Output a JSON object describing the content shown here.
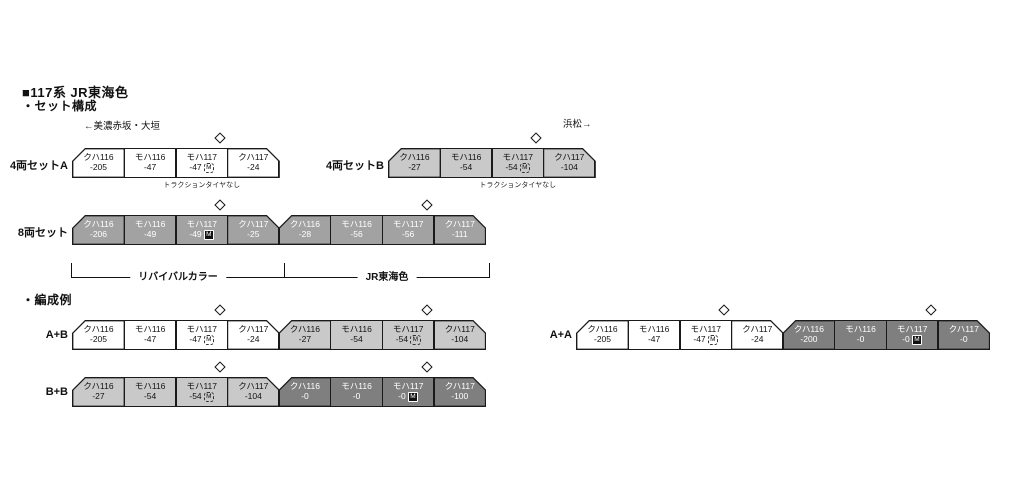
{
  "page": {
    "title": "■117系 JR東海色",
    "section_sets": "・セット構成",
    "section_examples": "・編成例",
    "direction_left": "←美濃赤坂・大垣",
    "direction_right": "浜松→"
  },
  "strings": {
    "m_label": "M"
  },
  "bracket": {
    "left_label": "リバイバルカラー",
    "right_label": "JR東海色"
  },
  "trains": [
    {
      "id": "set-4a",
      "label": "4両セットA",
      "x": 72,
      "y": 148,
      "cars": [
        {
          "type": "クハ116",
          "num": "-205",
          "shape": "cab-left",
          "style": "white",
          "note": "＞(消灯スイッチ付)",
          "noteAlign": "left"
        },
        {
          "type": "モハ116",
          "num": "-47",
          "shape": "mid",
          "style": "white"
        },
        {
          "type": "モハ117",
          "num": "-47",
          "m": "dashed",
          "pantograph": true,
          "shape": "mid",
          "style": "white",
          "note": "トラクションタイヤなし",
          "noteAlign": "center"
        },
        {
          "type": "クハ117",
          "num": "-24",
          "shape": "cab-right",
          "style": "white",
          "note": "(消灯スイッチ付)＜",
          "noteAlign": "right"
        }
      ]
    },
    {
      "id": "set-4b",
      "label": "4両セットB",
      "x": 388,
      "y": 148,
      "cars": [
        {
          "type": "クハ116",
          "num": "-27",
          "shape": "cab-left",
          "style": "lightgray",
          "note": "＞(消灯スイッチ付)",
          "noteAlign": "left"
        },
        {
          "type": "モハ116",
          "num": "-54",
          "shape": "mid",
          "style": "lightgray"
        },
        {
          "type": "モハ117",
          "num": "-54",
          "m": "dashed",
          "pantograph": true,
          "shape": "mid",
          "style": "lightgray",
          "note": "トラクションタイヤなし",
          "noteAlign": "center"
        },
        {
          "type": "クハ117",
          "num": "-104",
          "shape": "cab-right",
          "style": "lightgray",
          "note": "(消灯スイッチ付)＜",
          "noteAlign": "right"
        }
      ]
    },
    {
      "id": "set-8",
      "label": "8両セット",
      "x": 72,
      "y": 215,
      "cars": [
        {
          "type": "クハ116",
          "num": "-206",
          "shape": "cab-left",
          "style": "midgray",
          "note": "＞(消灯スイッチ付)",
          "noteAlign": "left"
        },
        {
          "type": "モハ116",
          "num": "-49",
          "shape": "mid",
          "style": "midgray"
        },
        {
          "type": "モハ117",
          "num": "-49",
          "m": "solid",
          "pantograph": true,
          "shape": "mid",
          "style": "midgray"
        },
        {
          "type": "クハ117",
          "num": "-25",
          "shape": "cab-right",
          "style": "midgray",
          "note": "(消灯スイッチ付)＜",
          "noteAlign": "right"
        },
        {
          "type": "クハ116",
          "num": "-28",
          "shape": "cab-left",
          "style": "midgray",
          "note": "＞(消灯スイッチ付)",
          "noteAlign": "left"
        },
        {
          "type": "モハ116",
          "num": "-56",
          "shape": "mid",
          "style": "midgray"
        },
        {
          "type": "モハ117",
          "num": "-56",
          "pantograph": true,
          "shape": "mid",
          "style": "midgray"
        },
        {
          "type": "クハ117",
          "num": "-111",
          "shape": "cab-right",
          "style": "midgray",
          "note": "(消灯スイッチ付)＜",
          "noteAlign": "right"
        }
      ]
    },
    {
      "id": "example-a-b",
      "label": "A+B",
      "x": 72,
      "y": 320,
      "cars": [
        {
          "type": "クハ116",
          "num": "-205",
          "shape": "cab-left",
          "style": "white"
        },
        {
          "type": "モハ116",
          "num": "-47",
          "shape": "mid",
          "style": "white"
        },
        {
          "type": "モハ117",
          "num": "-47",
          "m": "dashed",
          "pantograph": true,
          "shape": "mid",
          "style": "white"
        },
        {
          "type": "クハ117",
          "num": "-24",
          "shape": "cab-right",
          "style": "white"
        },
        {
          "type": "クハ116",
          "num": "-27",
          "shape": "cab-left",
          "style": "lightgray"
        },
        {
          "type": "モハ116",
          "num": "-54",
          "shape": "mid",
          "style": "lightgray"
        },
        {
          "type": "モハ117",
          "num": "-54",
          "m": "dashed",
          "pantograph": true,
          "shape": "mid",
          "style": "lightgray"
        },
        {
          "type": "クハ117",
          "num": "-104",
          "shape": "cab-right",
          "style": "lightgray"
        }
      ]
    },
    {
      "id": "example-a-a",
      "label": "A+A",
      "x": 576,
      "y": 320,
      "cars": [
        {
          "type": "クハ116",
          "num": "-205",
          "shape": "cab-left",
          "style": "white"
        },
        {
          "type": "モハ116",
          "num": "-47",
          "shape": "mid",
          "style": "white"
        },
        {
          "type": "モハ117",
          "num": "-47",
          "m": "dashed",
          "pantograph": true,
          "shape": "mid",
          "style": "white"
        },
        {
          "type": "クハ117",
          "num": "-24",
          "shape": "cab-right",
          "style": "white"
        },
        {
          "type": "クハ116",
          "num": "-200",
          "shape": "cab-left",
          "style": "darkgray"
        },
        {
          "type": "モハ116",
          "num": "-0",
          "shape": "mid",
          "style": "darkgray"
        },
        {
          "type": "モハ117",
          "num": "-0",
          "m": "solid",
          "pantograph": true,
          "shape": "mid",
          "style": "darkgray"
        },
        {
          "type": "クハ117",
          "num": "-0",
          "shape": "cab-right",
          "style": "darkgray"
        }
      ]
    },
    {
      "id": "example-b-b",
      "label": "B+B",
      "x": 72,
      "y": 377,
      "cars": [
        {
          "type": "クハ116",
          "num": "-27",
          "shape": "cab-left",
          "style": "lightgray"
        },
        {
          "type": "モハ116",
          "num": "-54",
          "shape": "mid",
          "style": "lightgray"
        },
        {
          "type": "モハ117",
          "num": "-54",
          "m": "dashed",
          "pantograph": true,
          "shape": "mid",
          "style": "lightgray"
        },
        {
          "type": "クハ117",
          "num": "-104",
          "shape": "cab-right",
          "style": "lightgray"
        },
        {
          "type": "クハ116",
          "num": "-0",
          "shape": "cab-left",
          "style": "darkgray"
        },
        {
          "type": "モハ116",
          "num": "-0",
          "shape": "mid",
          "style": "darkgray"
        },
        {
          "type": "モハ117",
          "num": "-0",
          "m": "solid",
          "pantograph": true,
          "shape": "mid",
          "style": "darkgray"
        },
        {
          "type": "クハ117",
          "num": "-100",
          "shape": "cab-right",
          "style": "darkgray"
        }
      ]
    }
  ]
}
